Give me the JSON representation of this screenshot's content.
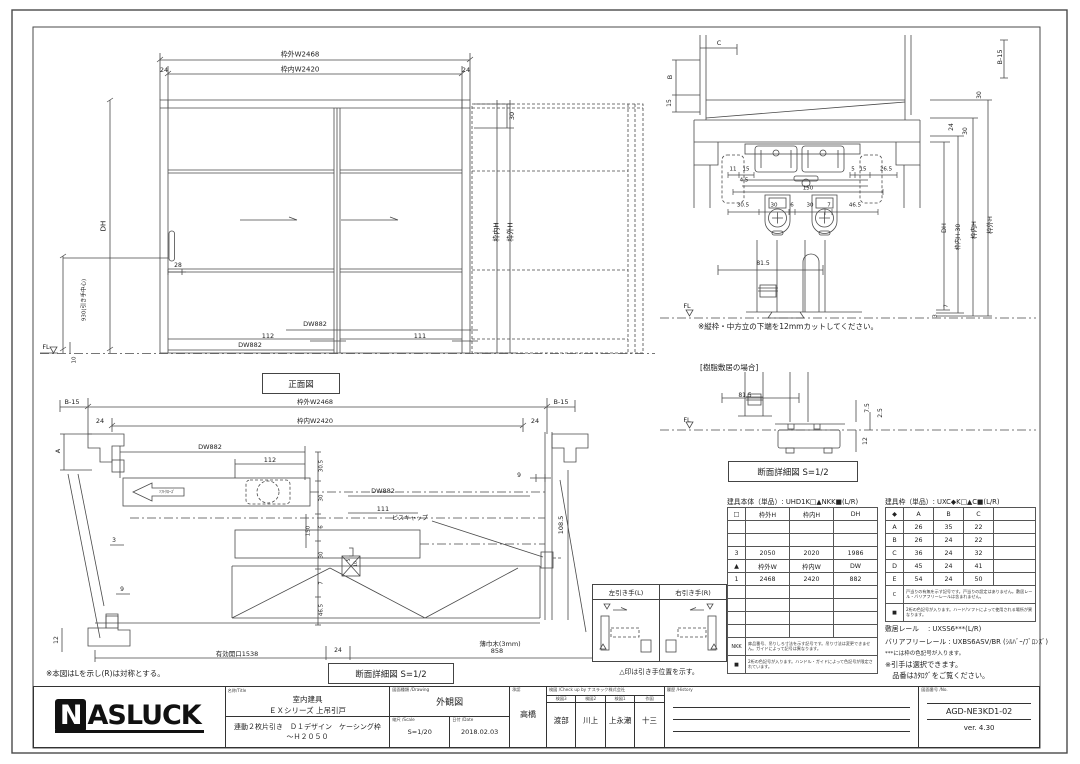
{
  "views": {
    "front": {
      "title": "正面図",
      "labels": [
        {
          "t": "枠外W2468",
          "x": 300,
          "y": 55,
          "s": 7
        },
        {
          "t": "枠内W2420",
          "x": 300,
          "y": 70,
          "s": 7
        },
        {
          "t": "24",
          "x": 164,
          "y": 70,
          "s": 6.5
        },
        {
          "t": "24",
          "x": 466,
          "y": 70,
          "s": 6.5
        },
        {
          "t": "30",
          "x": 512,
          "y": 116,
          "r": 1,
          "s": 6.5
        },
        {
          "t": "DH",
          "x": 104,
          "y": 226,
          "r": 1,
          "s": 7
        },
        {
          "t": "930(引き手中心)",
          "x": 85,
          "y": 300,
          "r": 1,
          "s": 5.5
        },
        {
          "t": "28",
          "x": 178,
          "y": 266,
          "s": 6
        },
        {
          "t": "DW882",
          "x": 250,
          "y": 345,
          "s": 6.5
        },
        {
          "t": "112",
          "x": 268,
          "y": 336,
          "s": 6.5
        },
        {
          "t": "DW882",
          "x": 315,
          "y": 324,
          "s": 6.5
        },
        {
          "t": "111",
          "x": 420,
          "y": 336,
          "s": 6.5
        },
        {
          "t": "FL",
          "x": 46,
          "y": 347,
          "s": 6.5
        },
        {
          "t": "10",
          "x": 75,
          "y": 360,
          "r": 1,
          "s": 5.5
        },
        {
          "t": "枠内H",
          "x": 497,
          "y": 232,
          "r": 1,
          "s": 7
        },
        {
          "t": "枠外H",
          "x": 511,
          "y": 232,
          "r": 1,
          "s": 7
        }
      ]
    },
    "section": {
      "title": "断面詳細図 S=1/2",
      "cut_note": "※縦枠・中方立の下端を12mmカットしてください。",
      "resin_case_label": "[樹脂敷居の場合]",
      "labels": [
        {
          "t": "C",
          "x": 719,
          "y": 43,
          "s": 6.5
        },
        {
          "t": "B-15",
          "x": 1000,
          "y": 57,
          "r": 1,
          "s": 6.5
        },
        {
          "t": "B",
          "x": 670,
          "y": 77,
          "r": 1,
          "s": 6.5
        },
        {
          "t": "15",
          "x": 670,
          "y": 103,
          "r": 1,
          "s": 6
        },
        {
          "t": "11",
          "x": 733,
          "y": 170,
          "s": 5.5
        },
        {
          "t": "15",
          "x": 746,
          "y": 170,
          "s": 5.5
        },
        {
          "t": "4.5",
          "x": 744,
          "y": 181,
          "s": 5.5
        },
        {
          "t": "5",
          "x": 853,
          "y": 170,
          "s": 5.5
        },
        {
          "t": "15",
          "x": 863,
          "y": 170,
          "s": 5.5
        },
        {
          "t": "26.5",
          "x": 886,
          "y": 170,
          "s": 5.5
        },
        {
          "t": "150",
          "x": 808,
          "y": 189,
          "s": 5.5
        },
        {
          "t": "30.5",
          "x": 743,
          "y": 206,
          "s": 5.5
        },
        {
          "t": "30",
          "x": 774,
          "y": 206,
          "s": 5.5
        },
        {
          "t": "6",
          "x": 792,
          "y": 206,
          "s": 5.5
        },
        {
          "t": "30",
          "x": 810,
          "y": 206,
          "s": 5.5
        },
        {
          "t": "7",
          "x": 829,
          "y": 206,
          "s": 5.5
        },
        {
          "t": "46.5",
          "x": 855,
          "y": 206,
          "s": 5.5
        },
        {
          "t": "81.5",
          "x": 763,
          "y": 264,
          "s": 6
        },
        {
          "t": "FL",
          "x": 687,
          "y": 306,
          "s": 6.5
        },
        {
          "t": "30",
          "x": 980,
          "y": 95,
          "r": 1,
          "s": 6
        },
        {
          "t": "24",
          "x": 952,
          "y": 127,
          "r": 1,
          "s": 6
        },
        {
          "t": "30",
          "x": 966,
          "y": 131,
          "r": 1,
          "s": 6
        },
        {
          "t": "DH",
          "x": 944,
          "y": 228,
          "r": 1,
          "s": 6.5
        },
        {
          "t": "枠内H-30",
          "x": 959,
          "y": 237,
          "r": 1,
          "s": 6
        },
        {
          "t": "枠内H",
          "x": 974,
          "y": 230,
          "r": 1,
          "s": 6.5
        },
        {
          "t": "枠外H",
          "x": 990,
          "y": 225,
          "r": 1,
          "s": 6.5
        },
        {
          "t": "7",
          "x": 947,
          "y": 306,
          "r": 1,
          "s": 5.5
        },
        {
          "t": "3",
          "x": 936,
          "y": 316,
          "r": 1,
          "s": 5.5
        },
        {
          "t": "81.5",
          "x": 745,
          "y": 396,
          "s": 6
        },
        {
          "t": "FL",
          "x": 687,
          "y": 420,
          "s": 6.5
        },
        {
          "t": "7.5",
          "x": 868,
          "y": 408,
          "r": 1,
          "s": 6
        },
        {
          "t": "2.5",
          "x": 881,
          "y": 413,
          "r": 1,
          "s": 6
        },
        {
          "t": "12",
          "x": 866,
          "y": 441,
          "r": 1,
          "s": 6
        }
      ]
    },
    "plan": {
      "title": "断面詳細図 S=1/2",
      "mirror_note": "※本図はLを示し(R)は対称とする。",
      "labels": [
        {
          "t": "B-15",
          "x": 72,
          "y": 402,
          "s": 6.5
        },
        {
          "t": "枠外W2468",
          "x": 315,
          "y": 402,
          "s": 6.5
        },
        {
          "t": "枠内W2420",
          "x": 315,
          "y": 421,
          "s": 6.5
        },
        {
          "t": "24",
          "x": 100,
          "y": 421,
          "s": 6.5
        },
        {
          "t": "24",
          "x": 535,
          "y": 421,
          "s": 6.5
        },
        {
          "t": "B-15",
          "x": 561,
          "y": 402,
          "s": 6.5
        },
        {
          "t": "A",
          "x": 58,
          "y": 451,
          "r": 1,
          "s": 6.5
        },
        {
          "t": "DW882",
          "x": 210,
          "y": 447,
          "s": 6.5
        },
        {
          "t": "112",
          "x": 270,
          "y": 460,
          "s": 6.5
        },
        {
          "t": "DW882",
          "x": 383,
          "y": 491,
          "s": 6.5
        },
        {
          "t": "111",
          "x": 383,
          "y": 509,
          "s": 6.5
        },
        {
          "t": "9",
          "x": 519,
          "y": 476,
          "s": 6
        },
        {
          "t": "108.5",
          "x": 561,
          "y": 525,
          "r": 1,
          "s": 6.5
        },
        {
          "t": "ビスキャップ",
          "x": 410,
          "y": 519,
          "s": 6
        },
        {
          "t": "3",
          "x": 114,
          "y": 541,
          "s": 6
        },
        {
          "t": "9",
          "x": 122,
          "y": 590,
          "s": 6
        },
        {
          "t": "12",
          "x": 57,
          "y": 640,
          "r": 1,
          "s": 6
        },
        {
          "t": "30.5",
          "x": 322,
          "y": 466,
          "r": 1,
          "s": 5.5
        },
        {
          "t": "30",
          "x": 322,
          "y": 498,
          "r": 1,
          "s": 5.5
        },
        {
          "t": "6",
          "x": 322,
          "y": 527,
          "r": 1,
          "s": 5.5
        },
        {
          "t": "150",
          "x": 309,
          "y": 531,
          "r": 1,
          "s": 5.5
        },
        {
          "t": "30",
          "x": 322,
          "y": 555,
          "r": 1,
          "s": 5.5
        },
        {
          "t": "7",
          "x": 322,
          "y": 583,
          "r": 1,
          "s": 5.5
        },
        {
          "t": "46.5",
          "x": 322,
          "y": 610,
          "r": 1,
          "s": 5.5
        },
        {
          "t": "5",
          "x": 350,
          "y": 560,
          "r": 1,
          "s": 4.5
        },
        {
          "t": "10",
          "x": 357,
          "y": 564,
          "r": 1,
          "s": 4.5
        },
        {
          "t": "薄巾木(3mm)",
          "x": 500,
          "y": 644,
          "s": 6.5
        },
        {
          "t": "24",
          "x": 338,
          "y": 651,
          "s": 6
        },
        {
          "t": "858",
          "x": 497,
          "y": 651,
          "s": 6.5
        },
        {
          "t": "有効開口1538",
          "x": 237,
          "y": 654,
          "s": 6.5
        },
        {
          "t": "ｿﾌﾄｸﾛｰｽﾞ",
          "x": 167,
          "y": 492,
          "s": 4
        }
      ]
    }
  },
  "handle_box": {
    "left_label": "左引き手(L)",
    "right_label": "右引き手(R)",
    "note": "△印は引き手位置を示す。"
  },
  "tables": {
    "door": {
      "title": "建具本体（単品）: UHD1K□▲NKK■(L/R)",
      "headers": [
        "□",
        "枠外H",
        "枠内H",
        "DH"
      ],
      "cols": [
        18,
        44,
        44,
        44
      ],
      "rows": [
        [
          "",
          "",
          "",
          ""
        ],
        [
          "",
          "",
          "",
          ""
        ],
        [
          "3",
          "2050",
          "2020",
          "1986"
        ],
        [
          "▲",
          "枠外W",
          "枠内W",
          "DW"
        ],
        [
          "1",
          "2468",
          "2420",
          "882"
        ],
        [
          "",
          "",
          "",
          ""
        ],
        [
          "",
          "",
          "",
          ""
        ],
        [
          "",
          "",
          "",
          ""
        ],
        [
          "",
          "",
          "",
          ""
        ]
      ],
      "note_rows": [
        {
          "sym": "NKK",
          "text": "扉品番号、吊りしろ寸法を示す記号です。吊り寸法は変更できません。ガイドによって記号は異なります。"
        },
        {
          "sym": "■",
          "text": "2桁の色記号が入ります。ハンドル・ガイドによって色記号が限定されています。"
        }
      ]
    },
    "frame": {
      "title": "建具枠（単品）: UXC◆K□▲C■(L/R)",
      "headers": [
        "◆",
        "A",
        "B",
        "C",
        ""
      ],
      "cols": [
        18,
        30,
        30,
        30,
        42
      ],
      "rows": [
        [
          "A",
          "26",
          "35",
          "22",
          ""
        ],
        [
          "B",
          "26",
          "24",
          "22",
          ""
        ],
        [
          "C",
          "36",
          "24",
          "32",
          ""
        ],
        [
          "D",
          "45",
          "24",
          "41",
          ""
        ],
        [
          "E",
          "54",
          "24",
          "50",
          ""
        ]
      ],
      "note_rows": [
        {
          "sym": "C",
          "text": "戸当りの有無を示す記号です。戸当りの設定はありません。敷居レール・バリアフリーレールは含まれません。"
        },
        {
          "sym": "■",
          "text": "2桁の色記号が入ります。ハード/ソフトによって使用される場所が異なります。"
        }
      ]
    }
  },
  "rail_info": {
    "sill_rail": "敷居レール　 : UXSS6***(L/R)",
    "barrier_free_rail": "バリアフリーレール : UXBS6ASV/BR (ｼﾙﾊﾞｰ/ﾌﾞﾛﾝｽﾞ)",
    "color_note": "***には枠の色記号が入ります。",
    "handle_note1": "※引手は選択できます。",
    "handle_note2": "　品番はｶﾀﾛｸﾞをご覧ください。"
  },
  "title_block": {
    "logo_n": "N",
    "logo_rest": "ASLUCK",
    "name_label": "名称/Title",
    "product_category": "室内建具",
    "product_series": "ＥＸシリーズ 上吊引戸",
    "product_spec": "連動２枚片引き　Ｄ１デザイン　ケーシング枠",
    "product_height": "～Ｈ２０５０",
    "drawing_label": "図面種類 /Drawing",
    "drawing_type": "外観図",
    "scale_label": "縮尺 /Scale",
    "scale": "S=1/20",
    "date_label": "日付 /Date",
    "date": "2018.02.03",
    "approver_label": "承認",
    "approver": "高橋",
    "check_label": "検図 /Check up by ナスラック株式会社",
    "check_cols": [
      {
        "label": "検図3",
        "value": "渡部"
      },
      {
        "label": "検図2",
        "value": "川上"
      },
      {
        "label": "検図1",
        "value": "上永瀬"
      },
      {
        "label": "作図",
        "value": "十三"
      }
    ],
    "history_label": "履歴 /History",
    "number_label": "図面番号 /No.",
    "number": "AGD-NE3KD1-02",
    "version": "ver. 4.30"
  }
}
